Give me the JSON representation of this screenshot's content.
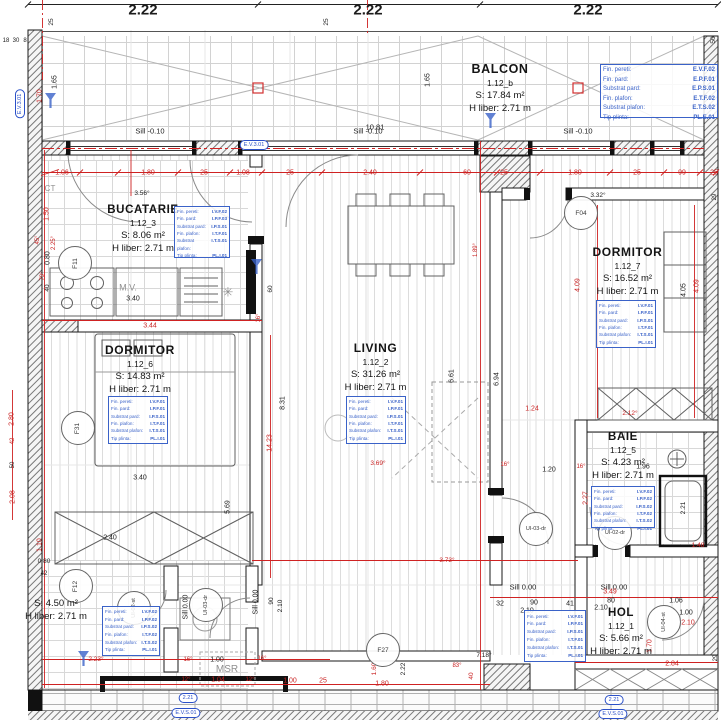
{
  "finish_labels": [
    "Fin. pereti:",
    "Fin. pard:",
    "Substrat pard:",
    "Fin. plafon:",
    "Substrat plafon:",
    "Tip plinta:"
  ],
  "rooms": [
    {
      "name": "BALCON",
      "id": "1.12_b",
      "area": "S: 17.84 m²",
      "height": "H liber: 2.71 m",
      "finishes": [
        "E.V.F.02",
        "E.P.F.01",
        "E.P.S.01",
        "E.T.F.02",
        "E.T.S.02",
        "PL.E.01"
      ]
    },
    {
      "name": "BUCATARIE",
      "id": "1.12_3",
      "area": "S: 8.06 m²",
      "height": "H liber: 2.71 m",
      "finishes": [
        "I.V.F.02",
        "I.P.F.03",
        "I.P.S.01",
        "I.T.F.01",
        "I.T.S.01",
        "PL.I.01"
      ]
    },
    {
      "name": "DORMITOR",
      "id": "1.12_6",
      "area": "S: 14.83 m²",
      "height": "H liber: 2.71 m",
      "finishes": [
        "I.V.F.01",
        "I.P.F.01",
        "I.P.S.01",
        "I.T.F.01",
        "I.T.S.01",
        "PL.I.01"
      ]
    },
    {
      "name": "LIVING",
      "id": "1.12_2",
      "area": "S: 31.26 m²",
      "height": "H liber: 2.71 m",
      "finishes": [
        "I.V.F.01",
        "I.P.F.01",
        "I.P.S.01",
        "I.T.F.01",
        "I.T.S.01",
        "PL.I.01"
      ]
    },
    {
      "name": "DORMITOR",
      "id": "1.12_7",
      "area": "S: 16.52 m²",
      "height": "H liber: 2.71 m",
      "finishes": [
        "I.V.F.01",
        "I.P.F.01",
        "I.P.S.01",
        "I.T.F.01",
        "I.T.S.01",
        "PL.I.01"
      ]
    },
    {
      "name": "BAIE",
      "id": "1.12_5",
      "area": "S: 4.23 m²",
      "height": "H liber: 2.71 m",
      "finishes": [
        "I.V.F.02",
        "I.P.F.02",
        "I.P.S.02",
        "I.T.F.02",
        "I.T.S.02",
        "PL.I.01"
      ]
    },
    {
      "name": "HOL",
      "id": "1.12_1",
      "area": "S: 5.66 m²",
      "height": "H liber: 2.71 m",
      "finishes": [
        "I.V.F.01",
        "I.P.F.01",
        "I.P.S.01",
        "I.T.F.01",
        "I.T.S.01",
        "PL.I.01"
      ]
    },
    {
      "name": "",
      "id": "",
      "area": "S: 4.50 m²",
      "height": "H liber: 2.71 m",
      "finishes": [
        "I.V.F.02",
        "I.P.F.02",
        "I.P.S.02",
        "I.T.F.02",
        "I.T.S.02",
        "PL.I.01"
      ]
    }
  ],
  "tags": [
    {
      "label": "F11",
      "x": 74,
      "y": 262,
      "rot": -90
    },
    {
      "label": "F31",
      "x": 77,
      "y": 427,
      "rot": -90
    },
    {
      "label": "F12",
      "x": 75,
      "y": 585,
      "rot": -90
    },
    {
      "label": "F04",
      "x": 580,
      "y": 212,
      "rot": 0
    },
    {
      "label": "F27",
      "x": 382,
      "y": 649,
      "rot": 0
    },
    {
      "label": "UI-02-st",
      "x": 133,
      "y": 607,
      "rot": -90
    },
    {
      "label": "UI-03-dr",
      "x": 205,
      "y": 604,
      "rot": -90
    },
    {
      "label": "UI-03-dr",
      "x": 535,
      "y": 528,
      "rot": 0
    },
    {
      "label": "UI-02-dr",
      "x": 614,
      "y": 532,
      "rot": 0
    },
    {
      "label": "UI-04-st",
      "x": 663,
      "y": 621,
      "rot": -90
    }
  ],
  "capsules": [
    {
      "t": "E.V.3.01",
      "x": 254,
      "y": 145
    },
    {
      "t": "E.V.3.01",
      "x": 20,
      "y": 104,
      "r": -90
    },
    {
      "t": "2.21",
      "x": 188,
      "y": 698
    },
    {
      "t": "E.V.S.01",
      "x": 186,
      "y": 713
    },
    {
      "t": "2.21",
      "x": 614,
      "y": 700
    },
    {
      "t": "E.V.S.01",
      "x": 613,
      "y": 714
    }
  ],
  "cones": [
    {
      "x": 50,
      "y": 100
    },
    {
      "x": 490,
      "y": 120
    },
    {
      "x": 256,
      "y": 266
    },
    {
      "x": 83,
      "y": 658
    }
  ],
  "annotations": [
    {
      "t": "2.22",
      "x": 143,
      "y": 10,
      "s": 15,
      "b": 1
    },
    {
      "t": "2.22",
      "x": 368,
      "y": 10,
      "s": 15,
      "b": 1
    },
    {
      "t": "2.22",
      "x": 588,
      "y": 10,
      "s": 15,
      "b": 1
    },
    {
      "t": "10.81",
      "x": 375,
      "y": 127,
      "s": 7.5
    },
    {
      "t": "25",
      "x": 52,
      "y": 22,
      "r": -90,
      "s": 6.5
    },
    {
      "t": "25",
      "x": 327,
      "y": 22,
      "r": -90,
      "s": 6.5
    },
    {
      "t": "50",
      "x": 714,
      "y": 40,
      "r": -90,
      "s": 6.5
    },
    {
      "t": "18",
      "x": 6,
      "y": 41,
      "s": 6
    },
    {
      "t": "30",
      "x": 16,
      "y": 41,
      "s": 6
    },
    {
      "t": "8",
      "x": 25,
      "y": 41,
      "s": 6
    },
    {
      "t": "1.65",
      "x": 55,
      "y": 82,
      "r": -90,
      "s": 7
    },
    {
      "t": "1.65",
      "x": 428,
      "y": 80,
      "r": -90,
      "s": 7
    },
    {
      "t": "1.70",
      "x": 40,
      "y": 96,
      "r": -90,
      "c": "r",
      "s": 7
    },
    {
      "t": "Sill -0.10",
      "x": 150,
      "y": 131,
      "s": 7.5
    },
    {
      "t": "Sill -0.10",
      "x": 368,
      "y": 131,
      "s": 7.5
    },
    {
      "t": "Sill -0.10",
      "x": 578,
      "y": 131,
      "s": 7.5
    },
    {
      "t": "1.06",
      "x": 62,
      "y": 173,
      "c": "r",
      "s": 7
    },
    {
      "t": "1.80",
      "x": 148,
      "y": 173,
      "c": "r",
      "s": 7
    },
    {
      "t": "25",
      "x": 204,
      "y": 173,
      "c": "r",
      "s": 7
    },
    {
      "t": "1.08",
      "x": 243,
      "y": 173,
      "c": "r",
      "s": 7
    },
    {
      "t": "25",
      "x": 290,
      "y": 173,
      "c": "r",
      "s": 7
    },
    {
      "t": "2.40",
      "x": 370,
      "y": 173,
      "c": "r",
      "s": 7
    },
    {
      "t": "60",
      "x": 467,
      "y": 173,
      "c": "r",
      "s": 7
    },
    {
      "t": "25",
      "x": 504,
      "y": 173,
      "c": "r",
      "s": 7
    },
    {
      "t": "1.80",
      "x": 575,
      "y": 173,
      "c": "r",
      "s": 7
    },
    {
      "t": "25",
      "x": 637,
      "y": 173,
      "c": "r",
      "s": 7
    },
    {
      "t": "99",
      "x": 682,
      "y": 173,
      "c": "r",
      "s": 7
    },
    {
      "t": "25",
      "x": 714,
      "y": 173,
      "c": "r",
      "s": 7
    },
    {
      "t": "CT",
      "x": 50,
      "y": 189,
      "c": "g",
      "s": 8
    },
    {
      "t": "3.56°",
      "x": 142,
      "y": 194,
      "s": 6.5
    },
    {
      "t": "3.32°",
      "x": 598,
      "y": 196,
      "s": 6.5
    },
    {
      "t": "29",
      "x": 715,
      "y": 197,
      "r": -90,
      "s": 6
    },
    {
      "t": "1.50",
      "x": 47,
      "y": 214,
      "r": -90,
      "c": "r",
      "s": 7
    },
    {
      "t": "45°",
      "x": 38,
      "y": 240,
      "r": -90,
      "c": "r",
      "s": 6
    },
    {
      "t": "2.25°",
      "x": 54,
      "y": 243,
      "r": -90,
      "c": "r",
      "s": 6
    },
    {
      "t": "0.80",
      "x": 48,
      "y": 258,
      "r": -90,
      "s": 7
    },
    {
      "t": "79°",
      "x": 43,
      "y": 276,
      "r": -90,
      "c": "r",
      "s": 6
    },
    {
      "t": "40",
      "x": 48,
      "y": 288,
      "r": -90,
      "s": 6.5
    },
    {
      "t": "M.V.",
      "x": 128,
      "y": 288,
      "c": "g",
      "s": 9
    },
    {
      "t": "3.40",
      "x": 133,
      "y": 299,
      "s": 7
    },
    {
      "t": "✳",
      "x": 228,
      "y": 292,
      "c": "g",
      "s": 13
    },
    {
      "t": "60",
      "x": 271,
      "y": 289,
      "r": -90,
      "s": 6.5
    },
    {
      "t": "16°",
      "x": 259,
      "y": 318,
      "r": -90,
      "c": "r",
      "s": 6
    },
    {
      "t": "3.44",
      "x": 150,
      "y": 326,
      "c": "r",
      "s": 7
    },
    {
      "t": "1.89°",
      "x": 476,
      "y": 250,
      "r": -90,
      "c": "r",
      "s": 6
    },
    {
      "t": "4.09",
      "x": 578,
      "y": 285,
      "r": -90,
      "c": "r",
      "s": 7
    },
    {
      "t": "4.05",
      "x": 684,
      "y": 290,
      "r": -90,
      "s": 7
    },
    {
      "t": "4.09",
      "x": 697,
      "y": 286,
      "r": -90,
      "c": "r",
      "s": 7
    },
    {
      "t": "8.31",
      "x": 283,
      "y": 403,
      "r": -90,
      "s": 7
    },
    {
      "t": "14.23",
      "x": 270,
      "y": 443,
      "r": -90,
      "c": "r",
      "s": 7
    },
    {
      "t": "6.61",
      "x": 452,
      "y": 376,
      "r": -90,
      "s": 7
    },
    {
      "t": "6.94",
      "x": 497,
      "y": 379,
      "r": -90,
      "s": 7
    },
    {
      "t": "2.80",
      "x": 12,
      "y": 419,
      "r": -90,
      "c": "r",
      "s": 7
    },
    {
      "t": "42",
      "x": 13,
      "y": 441,
      "r": -90,
      "c": "r",
      "s": 6
    },
    {
      "t": "50",
      "x": 13,
      "y": 465,
      "r": -90,
      "s": 6
    },
    {
      "t": "2.08",
      "x": 13,
      "y": 497,
      "r": -90,
      "c": "r",
      "s": 7
    },
    {
      "t": "3.40",
      "x": 140,
      "y": 478,
      "s": 7
    },
    {
      "t": "5.69",
      "x": 228,
      "y": 507,
      "r": -90,
      "s": 7
    },
    {
      "t": "2.40",
      "x": 110,
      "y": 538,
      "s": 7
    },
    {
      "t": "1.10",
      "x": 40,
      "y": 545,
      "r": -90,
      "c": "r",
      "s": 7
    },
    {
      "t": "3.69°",
      "x": 378,
      "y": 464,
      "c": "r",
      "s": 6.5
    },
    {
      "t": "1.24",
      "x": 532,
      "y": 409,
      "c": "r",
      "s": 7
    },
    {
      "t": "2.12°",
      "x": 630,
      "y": 414,
      "c": "r",
      "s": 6.5
    },
    {
      "t": "16°",
      "x": 505,
      "y": 465,
      "c": "r",
      "s": 6
    },
    {
      "t": "1.20",
      "x": 549,
      "y": 470,
      "s": 7
    },
    {
      "t": "16°",
      "x": 581,
      "y": 467,
      "c": "r",
      "s": 6
    },
    {
      "t": "1.96",
      "x": 643,
      "y": 467,
      "s": 7
    },
    {
      "t": "2.27",
      "x": 586,
      "y": 498,
      "r": -90,
      "c": "r",
      "s": 7
    },
    {
      "t": "2.21",
      "x": 684,
      "y": 508,
      "r": -90,
      "s": 6.5
    },
    {
      "t": "1.48",
      "x": 698,
      "y": 546,
      "c": "r",
      "s": 6.5
    },
    {
      "t": "3.73°",
      "x": 447,
      "y": 561,
      "c": "r",
      "s": 6.5
    },
    {
      "t": "0.80",
      "x": 44,
      "y": 562,
      "s": 6.5
    },
    {
      "t": "42",
      "x": 44,
      "y": 574,
      "s": 6
    },
    {
      "t": "Sill 0.00",
      "x": 256,
      "y": 602,
      "r": -90,
      "s": 7
    },
    {
      "t": "Sill 0.00",
      "x": 186,
      "y": 607,
      "r": -90,
      "s": 7
    },
    {
      "t": "Sill 0.00",
      "x": 523,
      "y": 587,
      "s": 7.5
    },
    {
      "t": "Sill 0.00",
      "x": 614,
      "y": 587,
      "s": 7.5
    },
    {
      "t": "3.49",
      "x": 610,
      "y": 592,
      "c": "r",
      "s": 7
    },
    {
      "t": "90",
      "x": 272,
      "y": 601,
      "r": -90,
      "s": 6.5
    },
    {
      "t": "2.10",
      "x": 281,
      "y": 606,
      "r": -90,
      "s": 6.5
    },
    {
      "t": "32",
      "x": 500,
      "y": 604,
      "s": 7
    },
    {
      "t": "90",
      "x": 534,
      "y": 603,
      "s": 7
    },
    {
      "t": "2.10",
      "x": 527,
      "y": 611,
      "s": 7
    },
    {
      "t": "41",
      "x": 570,
      "y": 604,
      "s": 7
    },
    {
      "t": "80",
      "x": 611,
      "y": 601,
      "s": 7
    },
    {
      "t": "2.10",
      "x": 601,
      "y": 608,
      "s": 7
    },
    {
      "t": "1.06",
      "x": 676,
      "y": 601,
      "s": 7
    },
    {
      "t": "1.00",
      "x": 686,
      "y": 613,
      "s": 7
    },
    {
      "t": "2.10",
      "x": 688,
      "y": 623,
      "c": "r",
      "s": 7
    },
    {
      "t": "1.70",
      "x": 650,
      "y": 646,
      "r": -90,
      "c": "r",
      "s": 7
    },
    {
      "t": "2.84",
      "x": 672,
      "y": 664,
      "c": "r",
      "s": 7
    },
    {
      "t": "29",
      "x": 716,
      "y": 658,
      "r": -90,
      "s": 6
    },
    {
      "t": "MSR",
      "x": 227,
      "y": 670,
      "c": "g",
      "s": 10
    },
    {
      "t": "2.23°",
      "x": 96,
      "y": 660,
      "c": "r",
      "s": 6.5
    },
    {
      "t": "16°",
      "x": 188,
      "y": 660,
      "c": "r",
      "s": 6
    },
    {
      "t": "1.00",
      "x": 217,
      "y": 660,
      "s": 7
    },
    {
      "t": "12°",
      "x": 186,
      "y": 680,
      "c": "r",
      "s": 6
    },
    {
      "t": "1.04",
      "x": 218,
      "y": 680,
      "c": "r",
      "s": 7
    },
    {
      "t": "16°",
      "x": 262,
      "y": 659,
      "c": "r",
      "s": 6
    },
    {
      "t": "12°",
      "x": 250,
      "y": 680,
      "c": "r",
      "s": 6
    },
    {
      "t": "1.00",
      "x": 290,
      "y": 681,
      "c": "r",
      "s": 7
    },
    {
      "t": "25",
      "x": 323,
      "y": 681,
      "c": "r",
      "s": 7
    },
    {
      "t": "1.80",
      "x": 382,
      "y": 684,
      "c": "r",
      "s": 7
    },
    {
      "t": "1.60",
      "x": 375,
      "y": 669,
      "r": -90,
      "c": "r",
      "s": 6.5
    },
    {
      "t": "2.22",
      "x": 404,
      "y": 669,
      "r": -90,
      "s": 6.5
    },
    {
      "t": "40",
      "x": 472,
      "y": 676,
      "r": -90,
      "c": "r",
      "s": 6.5
    },
    {
      "t": "7.18°",
      "x": 484,
      "y": 656,
      "s": 6.5
    },
    {
      "t": "83°",
      "x": 457,
      "y": 666,
      "c": "r",
      "s": 6
    }
  ]
}
